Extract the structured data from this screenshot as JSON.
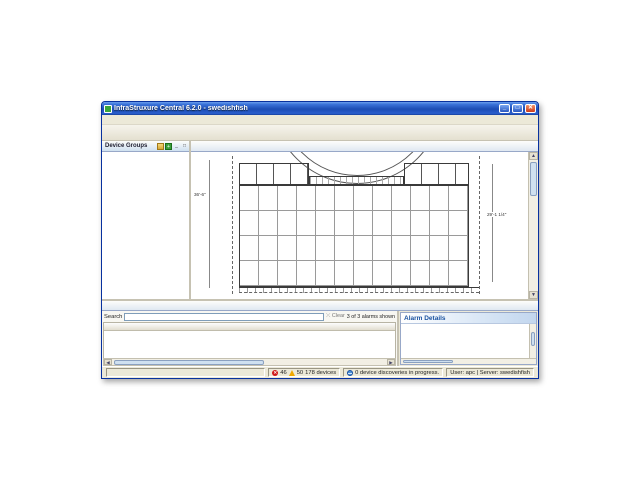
{
  "window": {
    "title": "InfraStruxure Central 6.2.0 - swedishfish"
  },
  "menubar": [
    "File",
    "Device",
    "Alarm Configuration",
    "Reports",
    "Updates",
    "System",
    "Window",
    "Help"
  ],
  "toolbar": [
    {
      "label": "Monitoring",
      "color": "#3fae49",
      "glyph": "~",
      "selected": true
    },
    {
      "label": "Surveillance",
      "color": "#3f7fd6",
      "glyph": "o",
      "selected": false
    },
    {
      "label": "Alarm Configuration",
      "color": "#e8842c",
      "glyph": "!",
      "selected": false
    },
    {
      "label": "Reports",
      "color": "#2ca8a0",
      "glyph": "=",
      "selected": false
    },
    {
      "label": "Power Management",
      "color": "#36a845",
      "glyph": "+",
      "selected": false
    }
  ],
  "sidebar": {
    "title": "Device Groups",
    "tree": [
      {
        "label": "All Devices",
        "level": 0,
        "icon": "group",
        "exp": "-",
        "selected": false
      },
      {
        "label": "Unassigned",
        "level": 1,
        "icon": "folder",
        "exp": null,
        "selected": false
      },
      {
        "label": "Brazil",
        "level": 1,
        "icon": "red",
        "exp": "-",
        "selected": false
      },
      {
        "label": "Sao Paulo",
        "level": 2,
        "icon": "green",
        "exp": null,
        "selected": false
      },
      {
        "label": "Canada",
        "level": 1,
        "icon": "red",
        "exp": "-",
        "selected": false
      },
      {
        "label": "Ontario",
        "level": 2,
        "icon": "red",
        "exp": null,
        "selected": false
      },
      {
        "label": "China",
        "level": 1,
        "icon": "red",
        "exp": "-",
        "selected": false
      },
      {
        "label": "Beijing",
        "level": 2,
        "icon": "red",
        "exp": null,
        "selected": false
      },
      {
        "label": "France",
        "level": 1,
        "icon": "red",
        "exp": "-",
        "selected": false
      },
      {
        "label": "Paris",
        "level": 2,
        "icon": "red",
        "exp": null,
        "selected": false
      },
      {
        "label": "India",
        "level": 1,
        "icon": "red",
        "exp": "-",
        "selected": false
      },
      {
        "label": "Hyderabad",
        "level": 2,
        "icon": "red",
        "exp": null,
        "selected": false
      },
      {
        "label": "Japan",
        "level": 1,
        "icon": "red",
        "exp": "-",
        "selected": false
      },
      {
        "label": "Tokyo",
        "level": 2,
        "icon": "red",
        "exp": null,
        "selected": false
      },
      {
        "label": "Russia",
        "level": 1,
        "icon": "red",
        "exp": "-",
        "selected": false
      },
      {
        "label": "St. Petersburg",
        "level": 2,
        "icon": "red",
        "exp": null,
        "selected": false
      },
      {
        "label": "Spain",
        "level": 1,
        "icon": "red",
        "exp": "-",
        "selected": false
      },
      {
        "label": "Madrid",
        "level": 2,
        "icon": "red",
        "exp": null,
        "selected": false
      },
      {
        "label": "UK",
        "level": 1,
        "icon": "red",
        "exp": "-",
        "selected": false
      },
      {
        "label": "London",
        "level": 2,
        "icon": "red",
        "exp": null,
        "selected": false
      },
      {
        "label": "US",
        "level": 1,
        "icon": "red",
        "exp": "-",
        "selected": false
      },
      {
        "label": "CA",
        "level": 2,
        "icon": "red",
        "exp": "+",
        "selected": false
      },
      {
        "label": "FL",
        "level": 2,
        "icon": "red",
        "exp": "+",
        "selected": false
      },
      {
        "label": "RI",
        "level": 2,
        "icon": "red",
        "exp": "-",
        "selected": false
      },
      {
        "label": "Providence",
        "level": 3,
        "icon": "red",
        "exp": null,
        "selected": true
      }
    ]
  },
  "viewTabs": [
    {
      "label": "Device View",
      "selected": false
    },
    {
      "label": "Map View",
      "selected": true
    }
  ],
  "mapToolbar": [
    {
      "name": "zoom-in-icon",
      "glyph": "+"
    },
    {
      "name": "zoom-out-icon",
      "glyph": "-"
    },
    {
      "name": "edit-map-icon",
      "glyph": "e"
    },
    {
      "name": "grid-icon",
      "glyph": "#"
    },
    {
      "name": "layout-icon",
      "glyph": "="
    },
    {
      "name": "scale-icon",
      "glyph": "S"
    },
    {
      "name": "rotate-icon",
      "glyph": "r"
    },
    {
      "name": "find-icon",
      "glyph": "q"
    },
    {
      "name": "minimize-view-icon",
      "glyph": "_"
    },
    {
      "name": "maximize-view-icon",
      "glyph": "n"
    }
  ],
  "map": {
    "dimLeft": "36'-6\"",
    "dimRight": "29'-1 1/4\"",
    "devices": [
      {
        "type": "pod",
        "cx": 61,
        "cy": 20,
        "label": "Rack Access Pod 170 ..."
      },
      {
        "type": "pod",
        "cx": 103,
        "cy": 20,
        "label": "Rack Access Pod 170 ..."
      },
      {
        "type": "pod",
        "cx": 233,
        "cy": 20,
        "label": "Rack Access Pod 170 ..."
      },
      {
        "type": "pod",
        "cx": 267,
        "cy": 20,
        "label": "Rack Access Pod 170 ..."
      },
      {
        "type": "alarm",
        "cx": 60,
        "cy": 79,
        "label": "NetBotz Rack Monitor ..."
      },
      {
        "type": "pod",
        "cx": 122,
        "cy": 78,
        "label": "Rack Access Pod 170 ..."
      },
      {
        "type": "pod",
        "cx": 163,
        "cy": 78,
        "label": "Rack Access Pod 170 ..."
      },
      {
        "type": "pod",
        "cx": 222,
        "cy": 79,
        "label": "Rack Access Pod 170 ..."
      },
      {
        "type": "door",
        "cx": 84,
        "cy": 118,
        "label": "Closed Door (1)"
      },
      {
        "type": "reader",
        "cx": 179,
        "cy": 116,
        "label": "Enabled Reader (1)"
      },
      {
        "type": "handle",
        "cx": 241,
        "cy": 116,
        "label": "Open Handle (1)"
      }
    ]
  },
  "panel": {
    "tabs": [
      {
        "label": "Active Alarms",
        "selected": true
      },
      {
        "label": "Saved Discoveries",
        "selected": false
      }
    ],
    "tools": [
      {
        "name": "chevrons-icon",
        "glyph": "»"
      },
      {
        "name": "pin-view-icon",
        "glyph": "p"
      },
      {
        "name": "alerts-icon",
        "glyph": "!"
      },
      {
        "name": "users-icon",
        "glyph": "u"
      },
      {
        "name": "minimize-panel-icon",
        "glyph": "_"
      },
      {
        "name": "maximize-panel-icon",
        "glyph": "n"
      }
    ],
    "searchLabel": "Search",
    "searchValue": "",
    "clearLabel": "Clear",
    "countLabel": "3 of 3 alarms shown",
    "columns": [
      "Clip",
      "Description",
      "Severity",
      "Device Hostname",
      "Alarm Type",
      "Location"
    ],
    "rows": [
      {
        "clip": false,
        "description": "The link 'http://216.218.16.239:80' is not currently functioning corre...",
        "severity": "Failure",
        "hostname": "NetBotz Rack Monitor 550",
        "alarmType": "Link Failed",
        "location": "West Kingston",
        "highlight": false
      },
      {
        "clip": true,
        "description": "The value of 'Ethernet Link Status' (Up) indicates that a 'Error' alert ...",
        "severity": "Error",
        "hostname": "NetBotz Rack Monitor 550",
        "alarmType": "Value Error",
        "location": "West Kingston",
        "highlight": true
      },
      {
        "clip": false,
        "description": "The system was configured to use an add-on or network drive for s...",
        "severity": "Failure",
        "hostname": "NetBotz Rack Monitor 550",
        "alarmType": "Drive Not Found",
        "location": "West Kingston",
        "highlight": false
      }
    ]
  },
  "details": {
    "title": "Alarm Details",
    "sections": [
      {
        "label": "Description",
        "expanded": true,
        "text": "The value of 'Ethernet Link Status' (Up) indicates that a 'Error' alert has occurred."
      },
      {
        "label": "Device Hostname",
        "expanded": false,
        "text": ""
      },
      {
        "label": "Alarm Name",
        "expanded": false,
        "text": ""
      },
      {
        "label": "Recommended Actions",
        "expanded": false,
        "text": ""
      }
    ]
  },
  "statusbar": {
    "errors": "46",
    "warnings": "50",
    "devices": "178 devices",
    "discovery": "0 device discoveries in progress.",
    "session": "User: apc | Server: swedishfish"
  }
}
